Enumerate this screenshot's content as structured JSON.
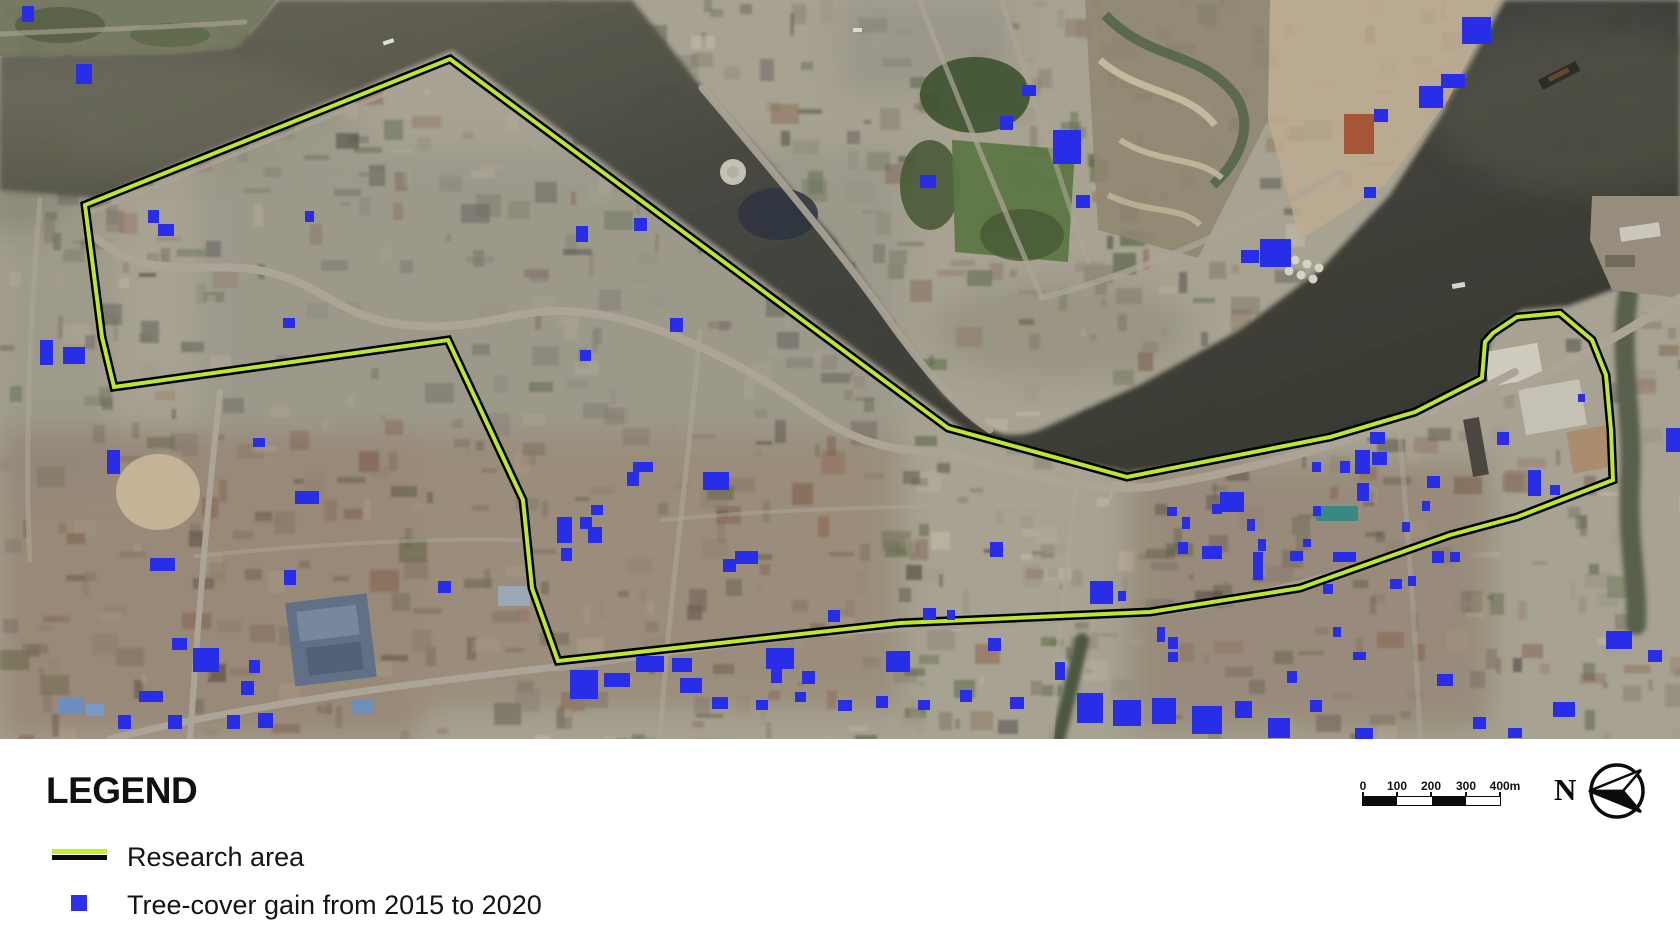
{
  "figure": {
    "description": "Satellite map of riverside urban study area"
  },
  "map": {
    "land_color": "#ada896",
    "water_color": "#3c3e34",
    "research_area": {
      "label": "Research area",
      "line_color": "#c3ef30",
      "casing_color": "#000000",
      "points": [
        [
          450,
          59
        ],
        [
          948,
          428
        ],
        [
          1127,
          477
        ],
        [
          1330,
          437
        ],
        [
          1415,
          412
        ],
        [
          1482,
          378
        ],
        [
          1485,
          342
        ],
        [
          1493,
          333
        ],
        [
          1517,
          317
        ],
        [
          1560,
          313
        ],
        [
          1592,
          340
        ],
        [
          1606,
          375
        ],
        [
          1611,
          430
        ],
        [
          1613,
          480
        ],
        [
          1517,
          517
        ],
        [
          1450,
          535
        ],
        [
          1300,
          588
        ],
        [
          1150,
          612
        ],
        [
          900,
          623
        ],
        [
          558,
          661
        ],
        [
          532,
          588
        ],
        [
          523,
          500
        ],
        [
          448,
          340
        ],
        [
          114,
          387
        ],
        [
          102,
          337
        ],
        [
          85,
          205
        ]
      ]
    },
    "tree_markers": {
      "label": "Tree-cover gain from 2015 to 2020",
      "color": "#2a30ee",
      "rects": [
        [
          22,
          6,
          12,
          16
        ],
        [
          76,
          64,
          16,
          20
        ],
        [
          148,
          210,
          11,
          13
        ],
        [
          305,
          211,
          9,
          11
        ],
        [
          158,
          224,
          16,
          12
        ],
        [
          283,
          318,
          12,
          10
        ],
        [
          40,
          340,
          13,
          25
        ],
        [
          63,
          347,
          22,
          17
        ],
        [
          576,
          226,
          12,
          16
        ],
        [
          634,
          218,
          13,
          13
        ],
        [
          670,
          318,
          13,
          14
        ],
        [
          580,
          350,
          11,
          11
        ],
        [
          107,
          450,
          13,
          24
        ],
        [
          253,
          438,
          12,
          9
        ],
        [
          295,
          491,
          24,
          13
        ],
        [
          150,
          558,
          25,
          13
        ],
        [
          284,
          570,
          12,
          15
        ],
        [
          438,
          581,
          13,
          12
        ],
        [
          172,
          638,
          15,
          12
        ],
        [
          193,
          648,
          26,
          24
        ],
        [
          249,
          660,
          11,
          13
        ],
        [
          241,
          681,
          13,
          14
        ],
        [
          139,
          691,
          24,
          11
        ],
        [
          118,
          715,
          13,
          14
        ],
        [
          168,
          715,
          14,
          14
        ],
        [
          227,
          715,
          13,
          14
        ],
        [
          258,
          713,
          15,
          15
        ],
        [
          633,
          462,
          20,
          10
        ],
        [
          627,
          472,
          12,
          14
        ],
        [
          703,
          472,
          26,
          18
        ],
        [
          591,
          505,
          12,
          10
        ],
        [
          557,
          517,
          15,
          26
        ],
        [
          580,
          517,
          12,
          12
        ],
        [
          588,
          527,
          14,
          16
        ],
        [
          561,
          548,
          11,
          13
        ],
        [
          735,
          551,
          23,
          13
        ],
        [
          723,
          559,
          13,
          13
        ],
        [
          570,
          670,
          28,
          29
        ],
        [
          604,
          673,
          26,
          14
        ],
        [
          636,
          656,
          28,
          16
        ],
        [
          672,
          658,
          20,
          14
        ],
        [
          680,
          678,
          22,
          15
        ],
        [
          712,
          697,
          16,
          12
        ],
        [
          756,
          700,
          12,
          10
        ],
        [
          795,
          692,
          11,
          10
        ],
        [
          766,
          648,
          28,
          21
        ],
        [
          771,
          669,
          11,
          14
        ],
        [
          802,
          671,
          13,
          13
        ],
        [
          828,
          610,
          12,
          12
        ],
        [
          886,
          651,
          24,
          21
        ],
        [
          990,
          542,
          13,
          15
        ],
        [
          923,
          608,
          13,
          12
        ],
        [
          947,
          610,
          8,
          10
        ],
        [
          988,
          638,
          13,
          13
        ],
        [
          1022,
          85,
          14,
          11
        ],
        [
          1000,
          116,
          13,
          14
        ],
        [
          1053,
          130,
          28,
          34
        ],
        [
          920,
          175,
          16,
          13
        ],
        [
          1076,
          195,
          14,
          13
        ],
        [
          1241,
          250,
          18,
          13
        ],
        [
          1374,
          109,
          14,
          13
        ],
        [
          1419,
          86,
          24,
          22
        ],
        [
          1441,
          74,
          24,
          14
        ],
        [
          1462,
          17,
          29,
          27
        ],
        [
          1364,
          187,
          12,
          11
        ],
        [
          1260,
          239,
          31,
          28
        ],
        [
          1370,
          432,
          15,
          12
        ],
        [
          1312,
          462,
          9,
          10
        ],
        [
          1340,
          461,
          10,
          12
        ],
        [
          1355,
          450,
          15,
          24
        ],
        [
          1372,
          452,
          15,
          13
        ],
        [
          1427,
          476,
          13,
          12
        ],
        [
          1357,
          483,
          12,
          18
        ],
        [
          1220,
          492,
          24,
          20
        ],
        [
          1212,
          504,
          10,
          10
        ],
        [
          1167,
          507,
          10,
          9
        ],
        [
          1182,
          517,
          8,
          12
        ],
        [
          1247,
          519,
          8,
          12
        ],
        [
          1313,
          506,
          8,
          10
        ],
        [
          1402,
          522,
          8,
          10
        ],
        [
          1422,
          501,
          8,
          10
        ],
        [
          1258,
          539,
          8,
          12
        ],
        [
          1290,
          551,
          13,
          10
        ],
        [
          1178,
          542,
          10,
          12
        ],
        [
          1202,
          546,
          20,
          13
        ],
        [
          1253,
          552,
          10,
          28
        ],
        [
          1333,
          552,
          23,
          10
        ],
        [
          1303,
          539,
          8,
          8
        ],
        [
          1323,
          584,
          10,
          10
        ],
        [
          1390,
          579,
          12,
          10
        ],
        [
          1432,
          551,
          12,
          12
        ],
        [
          1450,
          552,
          10,
          10
        ],
        [
          1090,
          581,
          23,
          23
        ],
        [
          1118,
          591,
          8,
          10
        ],
        [
          1157,
          627,
          8,
          15
        ],
        [
          1168,
          637,
          10,
          12
        ],
        [
          1168,
          652,
          10,
          10
        ],
        [
          1333,
          627,
          8,
          10
        ],
        [
          1353,
          652,
          13,
          8
        ],
        [
          1287,
          671,
          10,
          12
        ],
        [
          1408,
          576,
          8,
          10
        ],
        [
          1497,
          432,
          12,
          13
        ],
        [
          1528,
          470,
          13,
          26
        ],
        [
          1550,
          485,
          10,
          10
        ],
        [
          1578,
          394,
          7,
          8
        ],
        [
          1606,
          631,
          26,
          18
        ],
        [
          1648,
          650,
          14,
          12
        ],
        [
          1437,
          674,
          16,
          12
        ],
        [
          1666,
          428,
          14,
          24
        ],
        [
          1077,
          693,
          26,
          30
        ],
        [
          1113,
          700,
          28,
          26
        ],
        [
          1152,
          698,
          24,
          26
        ],
        [
          1192,
          706,
          30,
          28
        ],
        [
          1235,
          701,
          17,
          17
        ],
        [
          1268,
          718,
          22,
          20
        ],
        [
          1310,
          700,
          12,
          12
        ],
        [
          1355,
          728,
          18,
          11
        ],
        [
          1473,
          717,
          13,
          12
        ],
        [
          1508,
          728,
          14,
          10
        ],
        [
          1553,
          702,
          22,
          15
        ],
        [
          838,
          700,
          14,
          11
        ],
        [
          876,
          696,
          12,
          12
        ],
        [
          918,
          700,
          12,
          10
        ],
        [
          960,
          690,
          12,
          12
        ],
        [
          1010,
          697,
          14,
          12
        ],
        [
          1055,
          662,
          10,
          18
        ]
      ]
    }
  },
  "legend": {
    "title": "LEGEND",
    "items": [
      {
        "label": "Research area"
      },
      {
        "label": "Tree-cover gain from 2015 to 2020"
      }
    ]
  },
  "scale_bar": {
    "unit_labels": [
      "0",
      "100",
      "200",
      "300",
      "400m"
    ]
  },
  "north_arrow": {
    "label": "N"
  }
}
